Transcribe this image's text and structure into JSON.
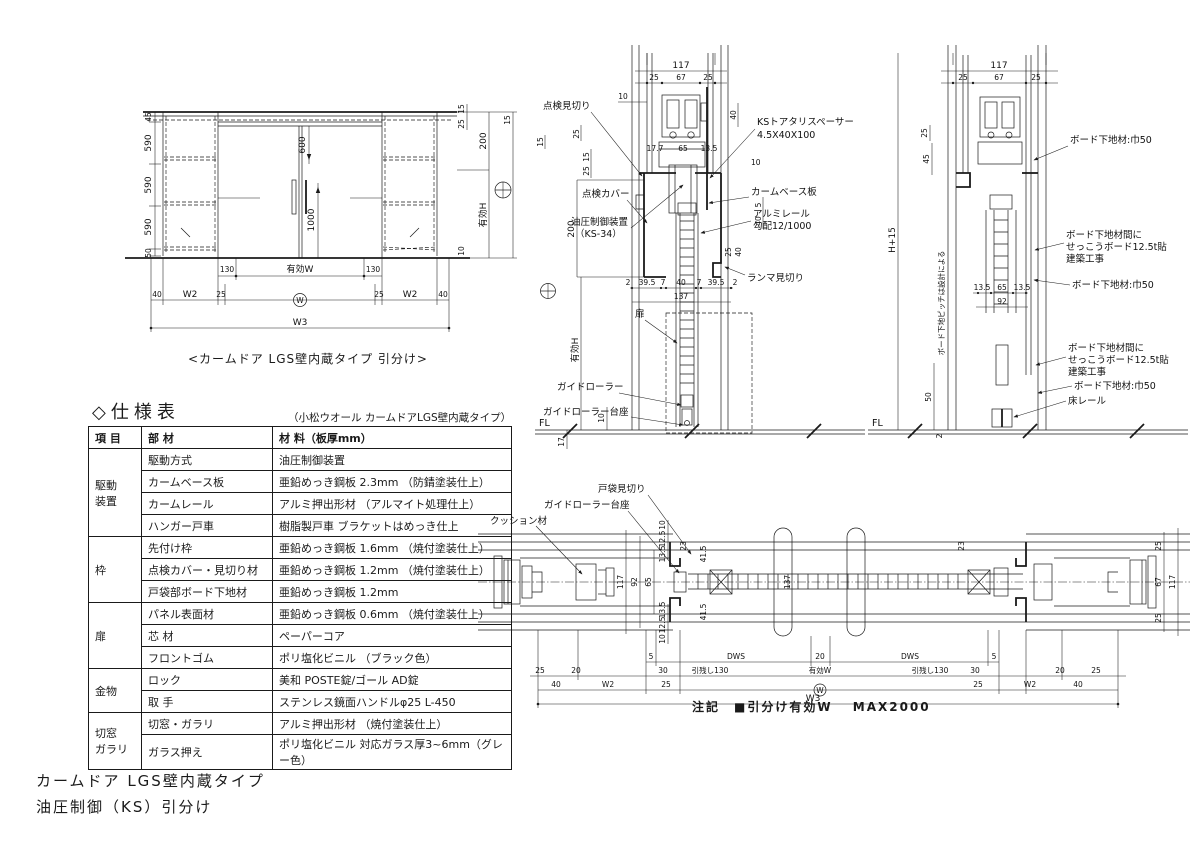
{
  "page": {
    "title_line1": "カームドア LGS壁内蔵タイプ",
    "title_line2": "油圧制御（KS）引分け",
    "note": "注記　■引分け有効W　 MAX2000"
  },
  "elevation": {
    "caption": "<カームドア LGS壁内蔵タイプ 引分け>",
    "left_dims": [
      "45",
      "590",
      "590",
      "590",
      "50"
    ],
    "dim_600": "600",
    "dim_1000": "1000",
    "row_130": [
      "130",
      "有効W",
      "130"
    ],
    "row_w": [
      "40",
      "W2",
      "25",
      "W",
      "25",
      "W2",
      "40"
    ],
    "dim_w3": "W3",
    "right_dims": {
      "d15a": "15",
      "d25a": "25",
      "d200": "200",
      "d15b": "15",
      "d10": "10",
      "eff_h": "有効H"
    }
  },
  "sec_mid": {
    "dim_117": "117",
    "top_dims": [
      "25",
      "67",
      "25"
    ],
    "dim_10_top": "10",
    "label_tenken_mikiri": "点検見切り",
    "label_tenken_cover": "点検カバー",
    "label_yuatsu1": "油圧制御装置",
    "label_yuatsu2": "（KS-34）",
    "left_dims": [
      "15",
      "25",
      "15",
      "25",
      "200"
    ],
    "label_ks1": "KSトアタリスペーサー",
    "label_ks2": "4.5X40X100",
    "label_cam_base": "カームベース板",
    "label_alumi1": "アルミレール",
    "label_alumi2": "勾配12/1000",
    "label_ranma": "ランマ見切り",
    "right_dims": [
      "40",
      "10",
      "5",
      "40",
      "25",
      "40"
    ],
    "mid_dims": [
      "17.7",
      "65",
      "13.5"
    ],
    "door_dims": [
      "2",
      "39.5",
      "7",
      "40",
      "7",
      "39.5",
      "2"
    ],
    "dim_137": "137",
    "label_tobira": "扉",
    "label_guide_roller": "ガイドローラー",
    "label_guide_base": "ガイドローラー台座",
    "eff_h": "有効H",
    "dim_10_btm": "10",
    "dim_17": "17",
    "fl": "FL"
  },
  "sec_right": {
    "dim_117": "117",
    "top_dims": [
      "25",
      "67",
      "25"
    ],
    "dim_25": "25",
    "dim_45": "45",
    "note_vert": "ボード下地ピッチは設計による",
    "dim_h15": "H+15",
    "label_b1": "ボード下地材:巾50",
    "label_b2a": "ボード下地材間に",
    "label_b2b": "せっこうボード12.5t貼",
    "label_b2c": "建築工事",
    "label_b3": "ボード下地材:巾50",
    "label_b4a": "ボード下地材間に",
    "label_b4b": "せっこうボード12.5t貼",
    "label_b4c": "建築工事",
    "label_b5": "ボード下地材:巾50",
    "label_floor_rail": "床レール",
    "mid_dims": [
      "13.5",
      "65",
      "13.5"
    ],
    "dim_92": "92",
    "dim_50": "50",
    "dim_2": "2",
    "fl": "FL"
  },
  "plan": {
    "label_cushion": "クッション材",
    "label_guide_base": "ガイドローラー台座",
    "label_tobukuro_mikiri": "戸袋見切り",
    "vdims_mid": [
      "117",
      "92",
      "65"
    ],
    "vdims_top": [
      "10",
      "12.5",
      "13.5"
    ],
    "vdims_btm": [
      "13.5",
      "12.5",
      "10"
    ],
    "dim_23L": "23",
    "dim_23R": "23",
    "dim_41a": "41.5",
    "dim_41b": "41.5",
    "dim_137": "137",
    "right_end_dims": [
      "25",
      "67",
      "25",
      "117"
    ],
    "row1": [
      "5",
      "DWS",
      "20",
      "DWS",
      "5"
    ],
    "row2": [
      "25",
      "20",
      "30",
      "引残し130",
      "有効W",
      "引残し130",
      "30",
      "20",
      "25"
    ],
    "row3": [
      "40",
      "W2",
      "25",
      "W",
      "25",
      "W2",
      "40"
    ],
    "dim_w3": "W3"
  },
  "spec": {
    "title": "◇仕様表",
    "subtitle": "（小松ウオール カームドアLGS壁内蔵タイプ）",
    "headers": [
      "項 目",
      "部 材",
      "材 料（板厚mm）"
    ],
    "rows": [
      {
        "group": "駆動\n装置",
        "part": "駆動方式",
        "material": "油圧制御装置"
      },
      {
        "part": "カームベース板",
        "material": "亜鉛めっき鋼板 2.3mm （防錆塗装仕上）"
      },
      {
        "part": "カームレール",
        "material": "アルミ押出形材 （アルマイト処理仕上）"
      },
      {
        "part": "ハンガー戸車",
        "material": "樹脂製戸車 ブラケットはめっき仕上"
      },
      {
        "group": "枠",
        "part": "先付け枠",
        "material": "亜鉛めっき鋼板 1.6mm （焼付塗装仕上）"
      },
      {
        "part": "点検カバー・見切り材",
        "material": "亜鉛めっき鋼板 1.2mm （焼付塗装仕上）"
      },
      {
        "part": "戸袋部ボード下地材",
        "material": "亜鉛めっき鋼板 1.2mm"
      },
      {
        "group": "扉",
        "part": "パネル表面材",
        "material": "亜鉛めっき鋼板 0.6mm （焼付塗装仕上）"
      },
      {
        "part": "芯 材",
        "material": "ペーパーコア"
      },
      {
        "part": "フロントゴム",
        "material": "ポリ塩化ビニル （ブラック色）"
      },
      {
        "group": "金物",
        "part": "ロック",
        "material": "美和 POSTE錠/ゴール AD錠"
      },
      {
        "part": "取 手",
        "material": "ステンレス鏡面ハンドルφ25 L-450"
      },
      {
        "group": "切窓\nガラリ",
        "part": "切窓・ガラリ",
        "material": "アルミ押出形材 （焼付塗装仕上）"
      },
      {
        "part": "ガラス押え",
        "material": "ポリ塩化ビニル 対応ガラス厚3~6mm（グレー色）"
      }
    ]
  }
}
